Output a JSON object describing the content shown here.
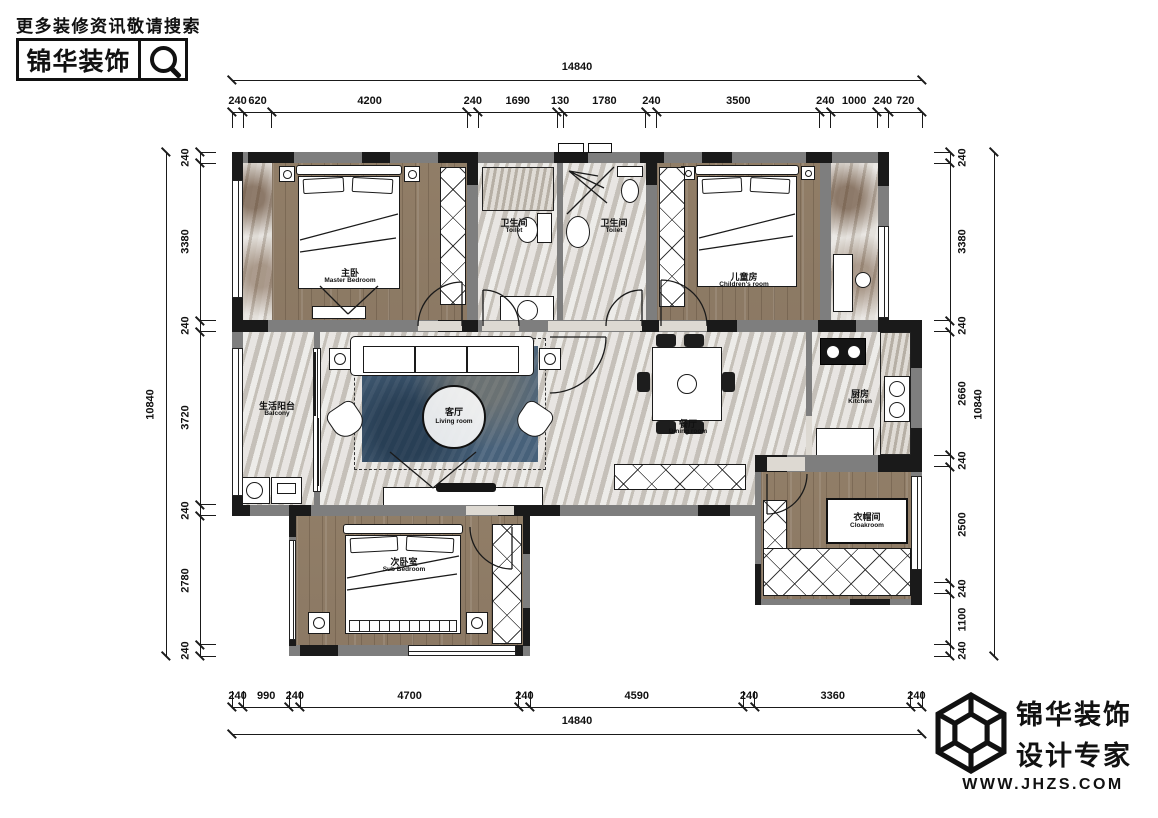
{
  "header": {
    "tagline": "更多装修资讯敬请搜索",
    "brand": "锦华装饰"
  },
  "footer": {
    "brand_line1": "锦华装饰",
    "brand_line2": "设计专家",
    "website": "WWW.JHZS.COM"
  },
  "dimensions": {
    "top": {
      "total": "14840",
      "segments": [
        240,
        620,
        4200,
        240,
        1690,
        130,
        1780,
        240,
        3500,
        240,
        1000,
        240,
        720
      ]
    },
    "bottom": {
      "total": "14840",
      "segments": [
        240,
        990,
        240,
        4700,
        240,
        4590,
        240,
        3360,
        240
      ]
    },
    "left": {
      "total": "10840",
      "segments": [
        240,
        3380,
        240,
        3720,
        240,
        2780,
        240
      ]
    },
    "right": {
      "total": "10840",
      "segments": [
        240,
        3380,
        240,
        2660,
        240,
        2500,
        240,
        1100,
        240
      ]
    }
  },
  "rooms": {
    "master": {
      "zh": "主卧",
      "en": "Master Bedroom"
    },
    "toilet1": {
      "zh": "卫生间",
      "en": "Toilet"
    },
    "toilet2": {
      "zh": "卫生间",
      "en": "Toilet"
    },
    "children": {
      "zh": "儿童房",
      "en": "Children's room"
    },
    "balcony": {
      "zh": "生活阳台",
      "en": "Balcony"
    },
    "living": {
      "zh": "客厅",
      "en": "Living room"
    },
    "dining": {
      "zh": "餐厅",
      "en": "Dining room"
    },
    "kitchen": {
      "zh": "厨房",
      "en": "Kitchen"
    },
    "cloakroom": {
      "zh": "衣帽间",
      "en": "Cloakroom"
    },
    "sub_bedroom": {
      "zh": "次卧室",
      "en": "Sub Bedroom"
    }
  },
  "colors": {
    "wall_gray": "#7e7e7e",
    "wall_black": "#1a1a1a",
    "wood": "#95826c",
    "marble": "#d8d4ce",
    "rug_blue": "#47617a"
  }
}
